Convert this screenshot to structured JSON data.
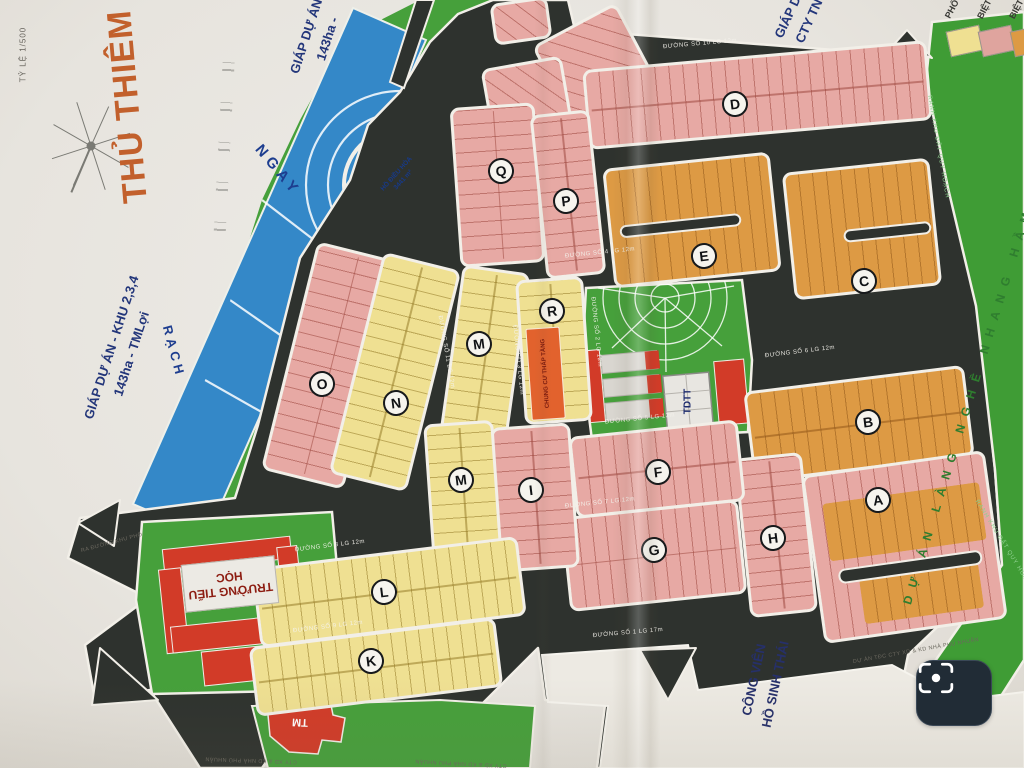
{
  "title": {
    "main": "THỦ THIÊM",
    "scale": "TỶ LỆ 1/500"
  },
  "margin_labels": {
    "left_project": [
      "GIÁP DỰ ÁN - KHU 2,3,4",
      "143ha - TMLợi"
    ],
    "top_project": [
      "GIÁP DỰ ÁN -",
      "143ha -"
    ],
    "top_right_project": [
      "GIÁP DỰ",
      "CTY TN"
    ]
  },
  "legend": {
    "items": [
      {
        "label": "PHỐ",
        "color": "#efe092"
      },
      {
        "label": "BIỆT",
        "color": "#dfa49e"
      },
      {
        "label": "BIỆT",
        "color": "#dd9a44"
      }
    ]
  },
  "water": {
    "river_upper": "NGAY",
    "river_lower": "RẠCH",
    "lake_name": "HỒ ĐIỀU HÒA",
    "lake_area": "3441 m²"
  },
  "parks": {
    "eco_line1": "CÔNG VIÊN",
    "eco_line2": "HỒ SINH THÁI"
  },
  "boundary": {
    "ranh": "RANH KHU ĐẤT QUY HOẠCH",
    "village": "DỰ ÁN LÀNG NGHỀ NHANG HẦM LONG"
  },
  "facilities": {
    "school": "TRƯỜNG TIỂU HỌC",
    "sports": "TDTT",
    "commerce": "TM",
    "apartment": "CHUNG CƯ THẤP TẦNG"
  },
  "blocks": [
    {
      "id": "D",
      "letter": "D",
      "type": "pink"
    },
    {
      "id": "Q",
      "letter": "Q",
      "type": "pink"
    },
    {
      "id": "P",
      "letter": "P",
      "type": "pink"
    },
    {
      "id": "E",
      "letter": "E",
      "type": "orange"
    },
    {
      "id": "C",
      "letter": "C",
      "type": "orange"
    },
    {
      "id": "O",
      "letter": "O",
      "type": "pink"
    },
    {
      "id": "N",
      "letter": "N",
      "type": "yellow"
    },
    {
      "id": "M1",
      "letter": "M",
      "type": "yellow"
    },
    {
      "id": "R",
      "letter": "R",
      "type": "yellow"
    },
    {
      "id": "B",
      "letter": "B",
      "type": "orange"
    },
    {
      "id": "A",
      "letter": "A",
      "type": "pink"
    },
    {
      "id": "H",
      "letter": "H",
      "type": "pink"
    },
    {
      "id": "F",
      "letter": "F",
      "type": "pink"
    },
    {
      "id": "G",
      "letter": "G",
      "type": "pink"
    },
    {
      "id": "I",
      "letter": "I",
      "type": "pink"
    },
    {
      "id": "M2",
      "letter": "M",
      "type": "yellow"
    },
    {
      "id": "L",
      "letter": "L",
      "type": "yellow"
    },
    {
      "id": "K",
      "letter": "K",
      "type": "yellow"
    }
  ],
  "roads": [
    "ĐƯỜNG SỐ 10 LG 12m",
    "ĐƯỜNG SỐ 4 LG 12m",
    "ĐƯỜNG SỐ 6 LG 12m",
    "ĐƯỜNG SỐ 5 LG 12m",
    "ĐƯỜNG SỐ 7 LG 12m",
    "ĐƯỜNG SỐ 1 LG 17m",
    "ĐƯỜNG SỐ 8 LG 12m",
    "ĐƯỜNG SỐ 9 LG 12m",
    "ĐƯỜNG SỐ 3 LG 12m",
    "ĐƯỜNG SỐ 2 LG 12m",
    "ĐƯỜNG SỐ 11 LG 12m"
  ],
  "fine_print": [
    "CTY XD & KD NHÀ PHÚ NHUẬN",
    "DỰ ÁN TĐC CTY XD & KD NHÀ PHÚ NHUẬN",
    "RA ĐƯỜNG KHU PHỐ"
  ],
  "ui": {
    "scan_button": "scan"
  }
}
